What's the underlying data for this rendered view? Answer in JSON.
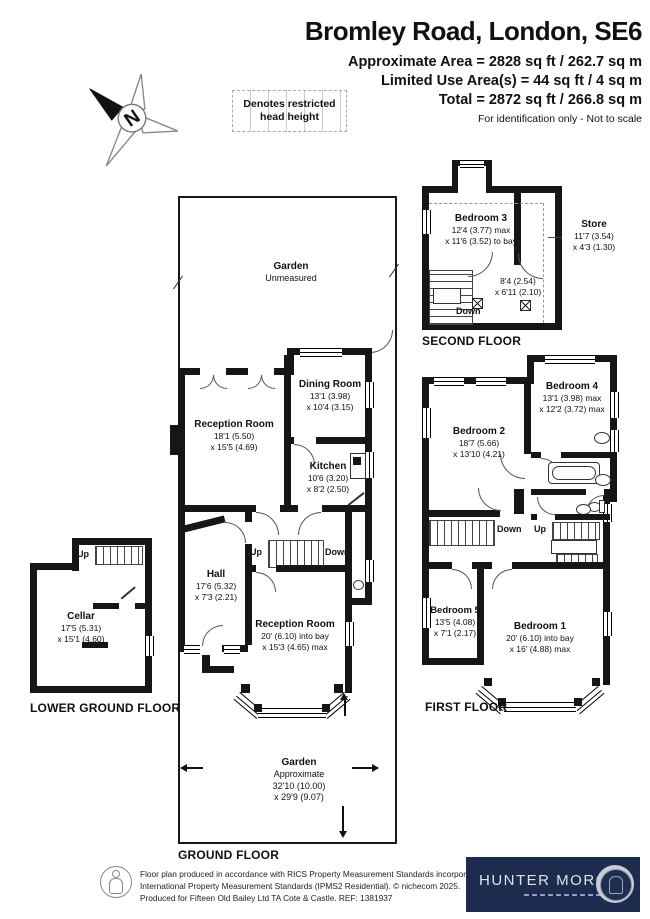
{
  "header": {
    "title": "Bromley Road, London, SE6",
    "area_line1": "Approximate Area = 2828 sq ft / 262.7 sq m",
    "area_line2": "Limited Use Area(s) = 44 sq ft / 4 sq m",
    "area_line3": "Total = 2872 sq ft / 266.8 sq m",
    "note": "For identification only - Not to scale"
  },
  "legend": {
    "restricted": "Denotes restricted head height"
  },
  "compass": {
    "north": "N"
  },
  "floors": {
    "second": {
      "label": "SECOND FLOOR",
      "bedroom3": {
        "name": "Bedroom 3",
        "dim1": "12'4 (3.77) max",
        "dim2": "x 11'6 (3.52) to bay"
      },
      "store": {
        "name": "Store",
        "dim1": "11'7 (3.54)",
        "dim2": "x 4'3 (1.30)"
      },
      "landing": {
        "dim1": "8'4 (2.54)",
        "dim2": "x 6'11 (2.10)"
      },
      "down": "Down"
    },
    "ground": {
      "label": "GROUND FLOOR",
      "garden_top": {
        "name": "Garden",
        "note": "Unmeasured"
      },
      "reception1": {
        "name": "Reception Room",
        "dim1": "18'1 (5.50)",
        "dim2": "x 15'5 (4.69)"
      },
      "dining": {
        "name": "Dining Room",
        "dim1": "13'1 (3.98)",
        "dim2": "x 10'4 (3.15)"
      },
      "kitchen": {
        "name": "Kitchen",
        "dim1": "10'6 (3.20)",
        "dim2": "x 8'2 (2.50)"
      },
      "hall": {
        "name": "Hall",
        "dim1": "17'6 (5.32)",
        "dim2": "x 7'3 (2.21)"
      },
      "reception2": {
        "name": "Reception Room",
        "dim1": "20' (6.10) into bay",
        "dim2": "x 15'3 (4.65) max"
      },
      "garden_bottom": {
        "name": "Garden",
        "note": "Approximate",
        "dim1": "32'10 (10.00)",
        "dim2": "x 29'9 (9.07)"
      },
      "up": "Up",
      "down": "Down"
    },
    "lower": {
      "label": "LOWER GROUND FLOOR",
      "cellar": {
        "name": "Cellar",
        "dim1": "17'5 (5.31)",
        "dim2": "x 15'1 (4.60)"
      },
      "up": "Up"
    },
    "first": {
      "label": "FIRST FLOOR",
      "bedroom2": {
        "name": "Bedroom 2",
        "dim1": "18'7 (5.66)",
        "dim2": "x 13'10 (4.21)"
      },
      "bedroom4": {
        "name": "Bedroom 4",
        "dim1": "13'1 (3.98) max",
        "dim2": "x 12'2 (3.72) max"
      },
      "bedroom5": {
        "name": "Bedroom 5",
        "dim1": "13'5 (4.08)",
        "dim2": "x 7'1 (2.17)"
      },
      "bedroom1": {
        "name": "Bedroom 1",
        "dim1": "20' (6.10) into bay",
        "dim2": "x 16' (4.88) max"
      },
      "down": "Down",
      "up": "Up"
    }
  },
  "footer": {
    "disclaimer_line1": "Floor plan produced in accordance with RICS Property Measurement Standards incorporating",
    "disclaimer_line2": "International Property Measurement Standards (IPMS2 Residential).   © nichecom 2025.",
    "disclaimer_line3": "Produced for Fifteen Old Bailey Ltd TA Cote & Castle.   REF:  1381937",
    "brand": "HUNTER MORGAN"
  },
  "colors": {
    "wall": "#161616",
    "logo_navy": "#1c2b4e"
  }
}
